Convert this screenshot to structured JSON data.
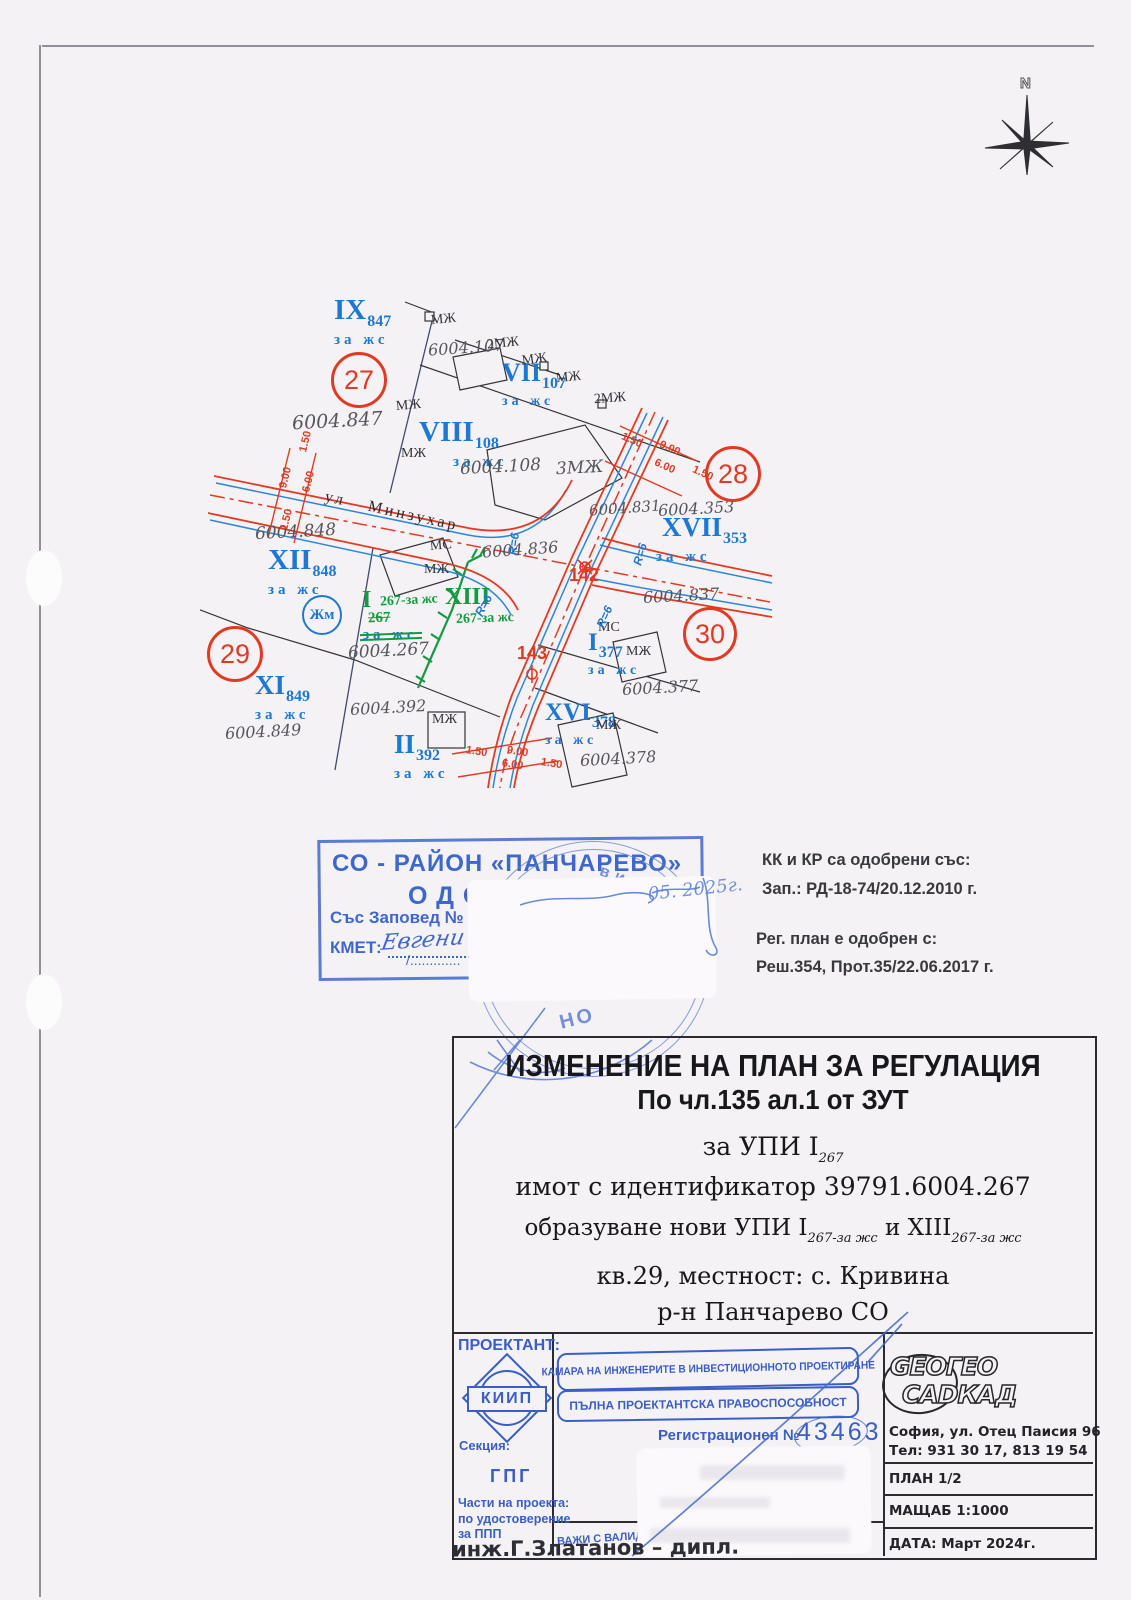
{
  "colors": {
    "paper": "#f5f2f5",
    "map_red": "#e23a22",
    "map_blue": "#1e78d2",
    "map_green": "#149b41",
    "boundary_blue": "#3f4a6e",
    "stamp_blue": "#3e67cd",
    "kiip_blue": "#3a5ec6",
    "ink": "#2b2b31"
  },
  "compass": {
    "north_label": "N"
  },
  "map": {
    "street_label": "ул  Минзухар",
    "zone_circle": "Жм",
    "block_circles": {
      "b27": "27",
      "b28": "28",
      "b29": "29",
      "b30": "30"
    },
    "crossings": {
      "p142": "142",
      "p143": "143"
    },
    "radius": {
      "r1": "R=6",
      "r2": "R=6",
      "r3": "R=6",
      "r4": "R=6"
    },
    "parcels": {
      "ix": {
        "n": "IX",
        "s": "847",
        "u": "за жс"
      },
      "vii": {
        "n": "VII",
        "s": "107",
        "u": "за жс"
      },
      "viii": {
        "n": "VIII",
        "s": "108",
        "u": "за жс",
        "mzh": "МЖ"
      },
      "xvii": {
        "n": "XVII",
        "s": "353",
        "u": "за жс"
      },
      "xii": {
        "n": "XII",
        "s": "848",
        "u": "за жс"
      },
      "xi": {
        "n": "XI",
        "s": "849",
        "u": "за жс"
      },
      "ii": {
        "n": "II",
        "s": "392",
        "u": "за жс"
      },
      "xvi": {
        "n": "XVI",
        "s": "378",
        "u": "за жс",
        "mzh": "МЖ"
      },
      "i377": {
        "n": "I",
        "s": "377",
        "u": "за жс",
        "mzh": "МЖ"
      },
      "i267": {
        "n": "I",
        "label": "267-за жс",
        "old": "267",
        "struck": "за жс"
      },
      "xiii": {
        "n": "XIII",
        "label": "267-за жс"
      }
    },
    "ids": {
      "a107": "6004.107",
      "a847": "6004.847",
      "a108": "6004.108",
      "a831": "6004.831",
      "a353": "6004.353",
      "a848": "6004.848",
      "a836": "6004.836",
      "a837": "6004.837",
      "a267": "6004.267",
      "a392": "6004.392",
      "a849": "6004.849",
      "a377": "6004.377",
      "a378": "6004.378"
    },
    "bldg": {
      "m1": "МЖ",
      "m2": "2МЖ",
      "m3": "МЖ",
      "m4": "МЖ",
      "m5": "2МЖ",
      "m6": "МЖ",
      "m8": "3МЖ",
      "m9": "МЖ",
      "m10": "МС",
      "m11": "МС",
      "m13": "МЖ"
    },
    "dims": {
      "d1": "1.50",
      "d2": "9.00",
      "d3": "6.00",
      "d4": "1.50"
    }
  },
  "stamp": {
    "line1": "СО - РАЙОН «ПАНЧАРЕВО»",
    "line2": "ОДОБРЕН",
    "line3": "Със Заповед №",
    "line4": "КМЕТ:",
    "signature": "Евгени",
    "date_note": "05. 2025г.",
    "round_fragment_top": "ви ф",
    "round_fragment_bottom": "НО"
  },
  "notes": {
    "kk_line1": "КК и КР са одобрени със:",
    "kk_line2": "Зап.: РД-18-74/20.12.2010 г.",
    "reg_line1": "Рег. план е одобрен с:",
    "reg_line2": "Реш.354, Прот.35/22.06.2017 г."
  },
  "title_block": {
    "title1": "ИЗМЕНЕНИЕ НА ПЛАН ЗА РЕГУЛАЦИЯ",
    "title2": "По чл.135 ал.1 от ЗУТ",
    "upi_pre": "за  УПИ  I",
    "upi_sub": "267",
    "imot": "имот  с  идентификатор  39791.6004.267",
    "obraz_pre": "образуване  нови  УПИ  I",
    "obraz_sub1": "267-за жс",
    "obraz_mid": "  и  XIII",
    "obraz_sub2": "267-за жс",
    "kv": "кв.29,  местност: с. Кривина",
    "rn": "р-н  Панчарево  СО"
  },
  "bottom": {
    "proektant": "ПРОЕКТАНТ:",
    "kiip": "КИИП",
    "banner1": "КАМАРА НА ИНЖЕНЕРИТЕ В ИНВЕСТИЦИОННОТО ПРОЕКТИРАНЕ",
    "banner2": "ПЪЛНА ПРОЕКТАНТСКА ПРАВОСПОСОБНОСТ",
    "reg_label": "Регистрационен №",
    "reg_number": "43463",
    "sekcia_label": "Секция:",
    "sekcia_value": "ГПГ",
    "chasti_1": "Части на проекта:",
    "chasti_2": "по удостоверение",
    "chasti_3": "за ППП",
    "vaji": "ВАЖИ С ВАЛИДНО У",
    "engineer": "инж.Г.Златанов  –  дипл.",
    "geocad_1": "GEOГЕО",
    "geocad_2": "CADКАД",
    "address": "София,  ул.  Отец  Паисия  96",
    "phone": "Тел:  931 30 17,  813 19 54",
    "plan": "ПЛАН  1/2",
    "mashtab": "МАЩАБ  1:1000",
    "data": "ДАТА:  Март  2024г."
  }
}
